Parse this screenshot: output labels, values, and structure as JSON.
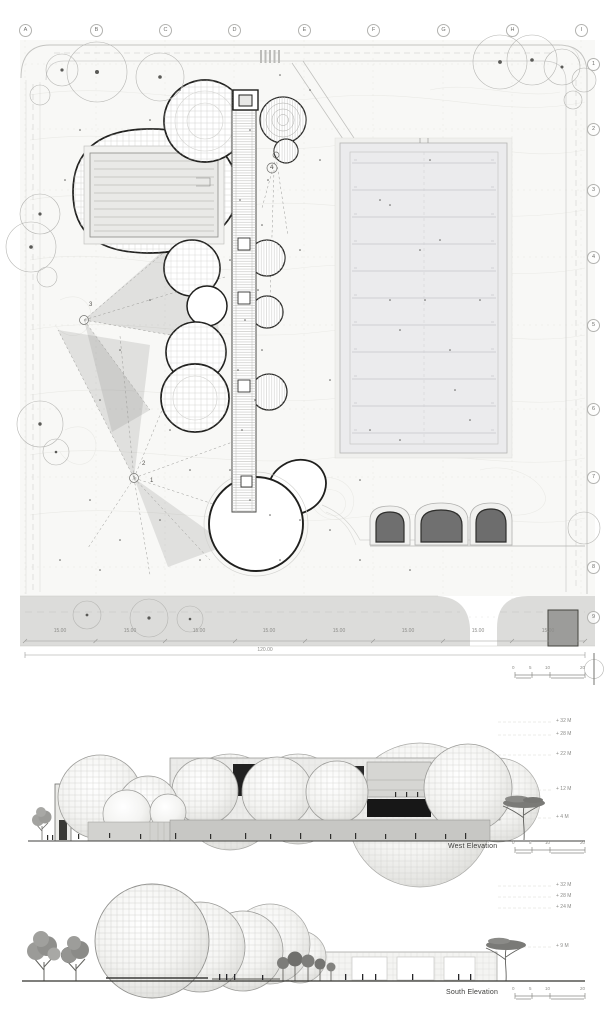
{
  "plan": {
    "grid_columns": [
      "A",
      "B",
      "C",
      "D",
      "E",
      "F",
      "G",
      "H",
      "I"
    ],
    "grid_rows": [
      "1",
      "2",
      "3",
      "4",
      "5",
      "6",
      "7",
      "8",
      "9"
    ],
    "viewpoints": [
      "1",
      "2",
      "3",
      "4"
    ],
    "bay_dimensions": [
      "15.00",
      "15.00",
      "15.00",
      "15.00",
      "15.00",
      "15.00",
      "15.00",
      "15.00"
    ],
    "total_dimension": "120.00",
    "scale_bar_ticks": [
      "0",
      "5",
      "10",
      "20"
    ]
  },
  "elevations": {
    "west": {
      "title": "West Elevation",
      "levels": [
        "+ 32 M",
        "+ 28 M",
        "+ 22 M",
        "+ 12 M",
        "+ 4 M"
      ],
      "scale_bar_ticks": [
        "0",
        "5",
        "10",
        "20"
      ]
    },
    "south": {
      "title": "South Elevation",
      "levels": [
        "+ 32 M",
        "+ 28 M",
        "+ 24 M",
        "+ 9 M"
      ],
      "scale_bar_ticks": [
        "0",
        "5",
        "10",
        "20"
      ]
    }
  },
  "colors": {
    "line_dark": "#1a1a1a",
    "line_mid": "#9a9a97",
    "line_light": "#d9d9d6",
    "ground_fill": "#f8f8f6",
    "road_fill": "#dcdcda",
    "field_fill": "#ebebed",
    "stone_fill": "#6f6f6f",
    "opening_fill": "#1d1d1d"
  }
}
